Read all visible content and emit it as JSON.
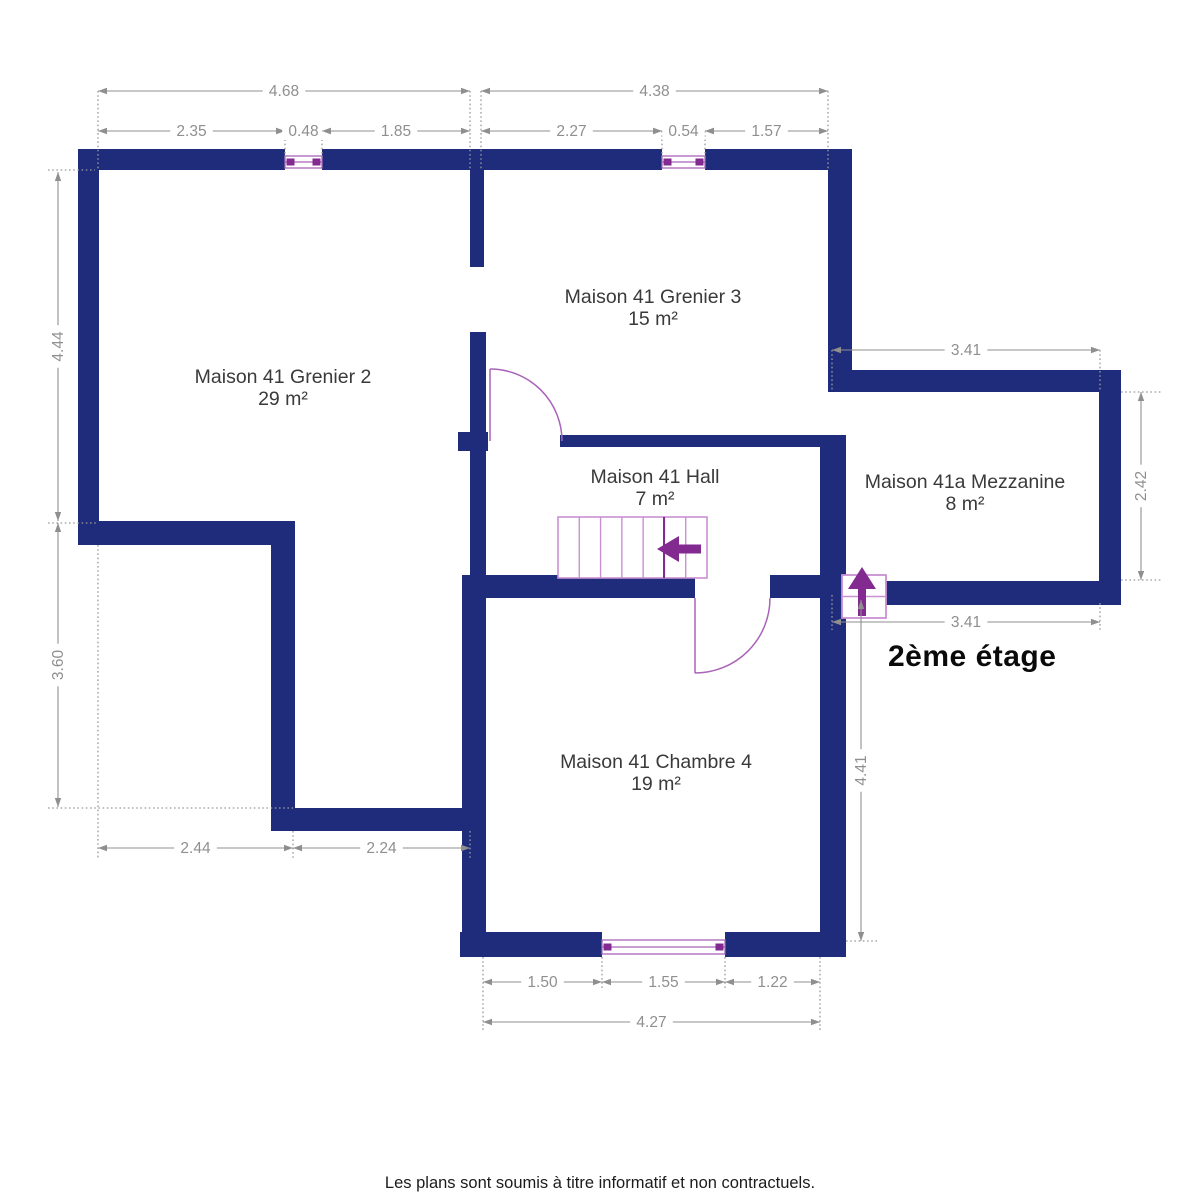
{
  "floor_label": "2ème étage",
  "disclaimer": "Les plans sont soumis à titre informatif et non contractuels.",
  "colors": {
    "wall": "#1f2b7b",
    "opening": "#a963b8",
    "opening_light": "#c990d2",
    "accent_dark": "#822a90",
    "dim": "#8f8f8f",
    "dim_dot": "#9a9a9a",
    "room_text": "#3a3a3a"
  },
  "rooms": [
    {
      "name": "Maison 41 Grenier 2",
      "area": "29 m²",
      "x": 283,
      "y": 377
    },
    {
      "name": "Maison 41 Grenier 3",
      "area": "15 m²",
      "x": 653,
      "y": 297
    },
    {
      "name": "Maison 41 Hall",
      "area": "7 m²",
      "x": 655,
      "y": 477
    },
    {
      "name": "Maison 41a Mezzanine",
      "area": "8 m²",
      "x": 965,
      "y": 482
    },
    {
      "name": "Maison 41 Chambre 4",
      "area": "19 m²",
      "x": 656,
      "y": 762
    }
  ],
  "walls": [
    [
      78,
      149,
      207,
      21
    ],
    [
      322,
      149,
      158,
      21
    ],
    [
      480,
      149,
      182,
      21
    ],
    [
      705,
      149,
      147,
      21
    ],
    [
      78,
      149,
      21,
      396
    ],
    [
      78,
      521,
      217,
      24
    ],
    [
      271,
      521,
      24,
      310
    ],
    [
      271,
      808,
      215,
      23
    ],
    [
      470,
      170,
      14,
      97
    ],
    [
      470,
      332,
      16,
      266
    ],
    [
      458,
      432,
      30,
      19
    ],
    [
      560,
      435,
      270,
      12
    ],
    [
      828,
      149,
      24,
      243
    ],
    [
      846,
      370,
      275,
      22
    ],
    [
      1099,
      370,
      22,
      235
    ],
    [
      846,
      581,
      275,
      24
    ],
    [
      820,
      435,
      26,
      522
    ],
    [
      470,
      575,
      225,
      23
    ],
    [
      770,
      575,
      76,
      23
    ],
    [
      462,
      575,
      24,
      382
    ],
    [
      460,
      932,
      142,
      25
    ],
    [
      725,
      932,
      121,
      25
    ]
  ],
  "windows": [
    {
      "x": 285,
      "y": 149,
      "w": 37,
      "h": 21
    },
    {
      "x": 662,
      "y": 149,
      "w": 43,
      "h": 21
    },
    {
      "x": 602,
      "y": 932,
      "w": 123,
      "h": 25
    }
  ],
  "doors": [
    {
      "leaf": [
        490,
        441,
        490,
        369
      ],
      "arc": "M 490 369 A 72 72 0 0 1 562 441"
    },
    {
      "leaf": [
        695,
        598,
        695,
        673
      ],
      "arc": "M 695 673 A 75 75 0 0 0 770 598"
    }
  ],
  "stairs": {
    "main": {
      "x": 558,
      "y": 517,
      "w": 149,
      "h": 61,
      "treads": 7,
      "dark_divider": 664,
      "arrow_points": "657,549 679,536 679,544.5 701,544.5 701,553.5 679,553.5 679,562"
    },
    "arrival": {
      "x": 842,
      "y": 575,
      "w": 44,
      "h": 43,
      "arrow_points": "862,567 876,589 866,589 866,616 858,616 858,589 848,589"
    }
  },
  "dimensions": [
    {
      "label": "4.68",
      "p": [
        98,
        91,
        470,
        91
      ]
    },
    {
      "label": "4.38",
      "p": [
        481,
        91,
        828,
        91
      ]
    },
    {
      "label": "2.35",
      "p": [
        98,
        131,
        285,
        131
      ]
    },
    {
      "label": "0.48",
      "p": [
        285,
        131,
        322,
        131
      ],
      "narrow": true
    },
    {
      "label": "1.85",
      "p": [
        322,
        131,
        470,
        131
      ]
    },
    {
      "label": "2.27",
      "p": [
        481,
        131,
        662,
        131
      ]
    },
    {
      "label": "0.54",
      "p": [
        662,
        131,
        705,
        131
      ],
      "narrow": true
    },
    {
      "label": "1.57",
      "p": [
        705,
        131,
        828,
        131
      ]
    },
    {
      "label": "4.44",
      "p": [
        58,
        172,
        58,
        521
      ],
      "vert": true
    },
    {
      "label": "3.60",
      "p": [
        58,
        523,
        58,
        807
      ],
      "vert": true
    },
    {
      "label": "2.44",
      "p": [
        98,
        848,
        293,
        848
      ]
    },
    {
      "label": "2.24",
      "p": [
        293,
        848,
        470,
        848
      ]
    },
    {
      "label": "1.50",
      "p": [
        483,
        982,
        602,
        982
      ]
    },
    {
      "label": "1.55",
      "p": [
        602,
        982,
        725,
        982
      ]
    },
    {
      "label": "1.22",
      "p": [
        725,
        982,
        820,
        982
      ]
    },
    {
      "label": "4.27",
      "p": [
        483,
        1022,
        820,
        1022
      ]
    },
    {
      "label": "3.41",
      "p": [
        832,
        350,
        1100,
        350
      ]
    },
    {
      "label": "3.41",
      "p": [
        832,
        622,
        1100,
        622
      ]
    },
    {
      "label": "2.42",
      "p": [
        1141,
        392,
        1141,
        580
      ],
      "vert": true
    },
    {
      "label": "4.41",
      "p": [
        861,
        600,
        861,
        941
      ],
      "vert": true
    }
  ],
  "extensions": [
    [
      98,
      91,
      98,
      169
    ],
    [
      285,
      131,
      285,
      160
    ],
    [
      322,
      131,
      322,
      160
    ],
    [
      470,
      91,
      470,
      170
    ],
    [
      481,
      91,
      481,
      170
    ],
    [
      662,
      131,
      662,
      160
    ],
    [
      705,
      131,
      705,
      160
    ],
    [
      828,
      91,
      828,
      170
    ],
    [
      48,
      170,
      95,
      170
    ],
    [
      48,
      523,
      98,
      523
    ],
    [
      48,
      808,
      293,
      808
    ],
    [
      98,
      545,
      98,
      858
    ],
    [
      293,
      831,
      293,
      858
    ],
    [
      470,
      831,
      470,
      858
    ],
    [
      483,
      957,
      483,
      1032
    ],
    [
      602,
      957,
      602,
      990
    ],
    [
      725,
      957,
      725,
      990
    ],
    [
      820,
      957,
      820,
      1032
    ],
    [
      832,
      350,
      832,
      392
    ],
    [
      1100,
      350,
      1100,
      392
    ],
    [
      832,
      595,
      832,
      630
    ],
    [
      1100,
      603,
      1100,
      630
    ],
    [
      1121,
      392,
      1162,
      392
    ],
    [
      1121,
      580,
      1162,
      580
    ],
    [
      846,
      941,
      878,
      941
    ]
  ]
}
